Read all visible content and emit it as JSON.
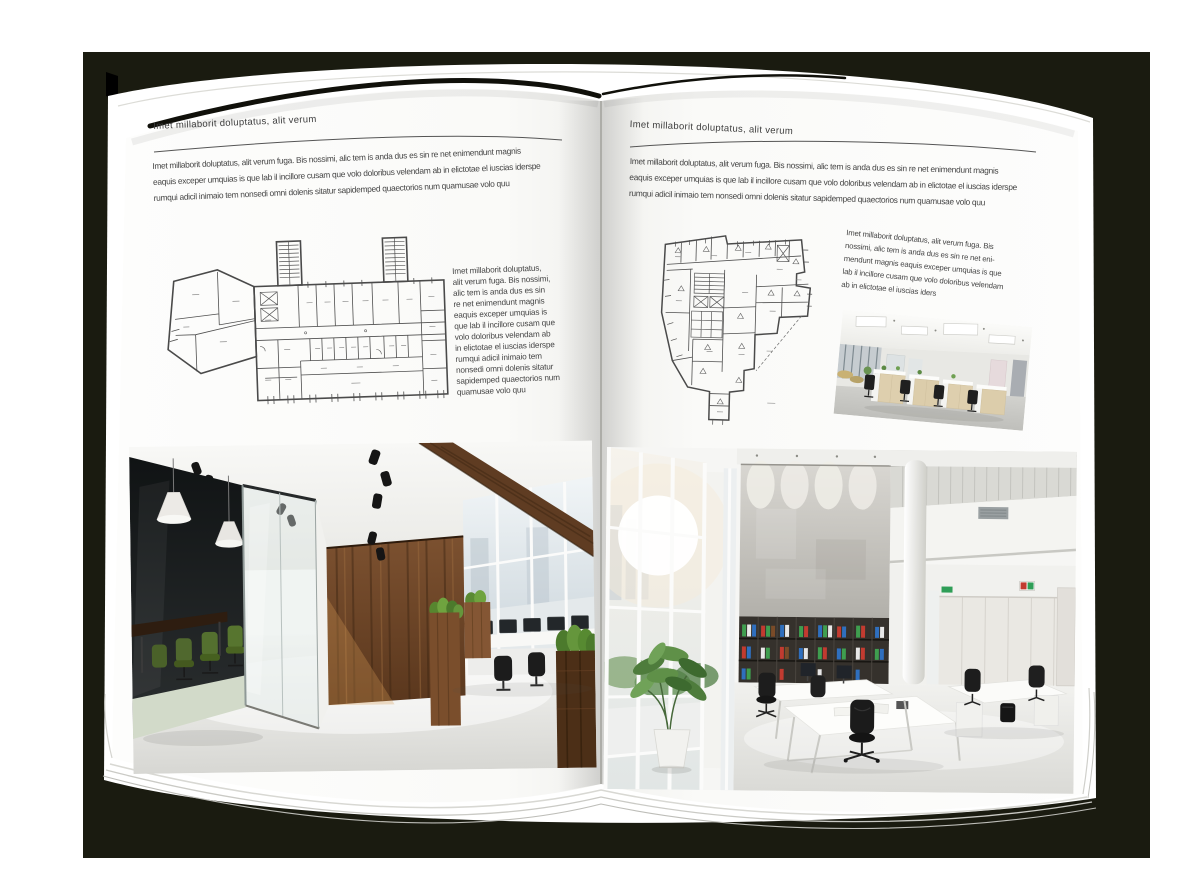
{
  "palette": {
    "backdrop": "#1a1b10",
    "page": "#ffffff",
    "text": "#454545",
    "rule": "#555555",
    "plan_line": "#4a4a4a",
    "wood_brown": "#6e4627",
    "chair_green": "#50682e",
    "plant_green": "#4e7c3c",
    "binder_green": "#3f9e4f",
    "binder_blue": "#2f6fbe",
    "binder_red": "#c23b30"
  },
  "left_page": {
    "header": "Imet millaborit doluptatus, alit verum",
    "intro": "Imet millaborit doluptatus, alit verum fuga. Bis nossimi, alic tem is anda dus es sin re net enimendunt magnis\neaquis exceper umquias is que lab il incillore cusam que volo doloribus velendam ab in elictotae el iuscias iderspe\nrumqui adicil inimaio tem nonsedi omni dolenis sitatur sapidemped quaectorios num quamusae volo quu",
    "side_text": "Imet millaborit doluptatus,\nalit verum fuga. Bis nossimi,\nalic tem is anda dus es sin\nre net enimendunt magnis\neaquis exceper umquias is\nque lab il incillore cusam que\nvolo doloribus velendam ab\nin elictotae el iuscias iderspe\nrumqui adicil inimaio tem\nnonsedi omni dolenis sitatur\nsapidemped quaectorios num\nquamusae volo quu"
  },
  "right_page": {
    "header": "Imet millaborit doluptatus, alit verum",
    "intro": "Imet millaborit doluptatus, alit verum fuga. Bis nossimi, alic tem is anda dus es sin re net enimendunt magnis\neaquis exceper umquias is que lab il incillore cusam que volo doloribus velendam ab in elictotae el iuscias iderspe\nrumqui adicil inimaio tem nonsedi omni dolenis sitatur sapidemped quaectorios num quamusae volo quu",
    "side_text": "Imet millaborit doluptatus, alit verum fuga. Bis\nnossimi, alic tem is anda dus es sin re net eni-\nmendunt magnis eaquis exceper umquias is que\nlab il incillore cusam que volo doloribus velendam\nab in elictotae el iuscias iders"
  }
}
